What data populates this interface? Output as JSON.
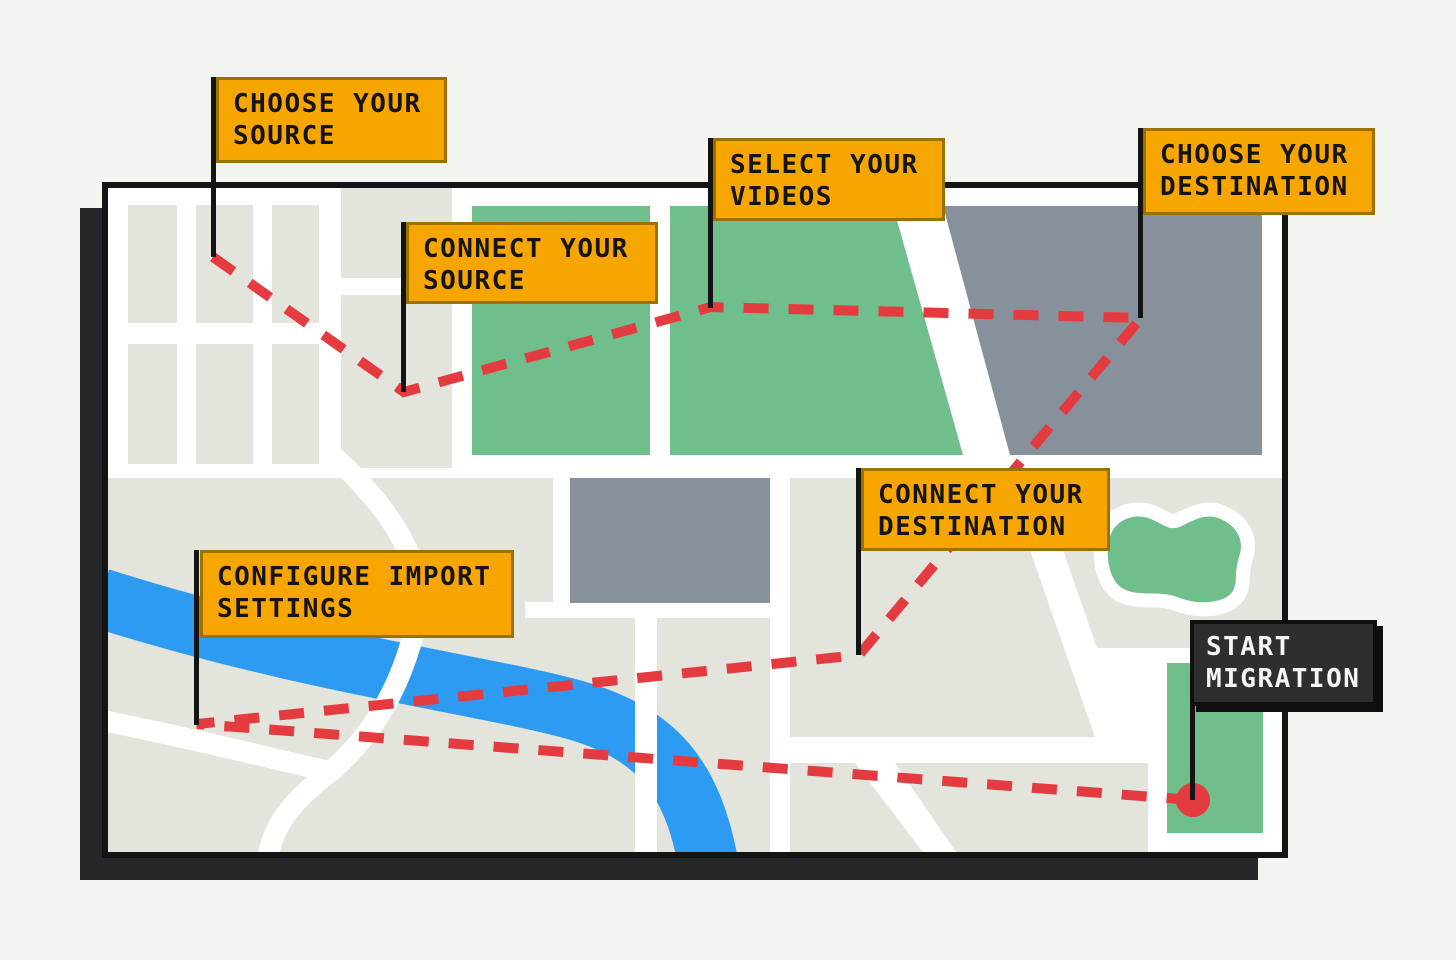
{
  "steps": [
    {
      "id": "choose-source",
      "label": "CHOOSE YOUR SOURCE",
      "line1": "CHOOSE YOUR",
      "line2": "SOURCE",
      "style": "orange"
    },
    {
      "id": "connect-source",
      "label": "CONNECT YOUR SOURCE",
      "line1": "CONNECT YOUR",
      "line2": "SOURCE",
      "style": "orange"
    },
    {
      "id": "select-videos",
      "label": "SELECT YOUR VIDEOS",
      "line1": "SELECT YOUR",
      "line2": "VIDEOS",
      "style": "orange"
    },
    {
      "id": "choose-destination",
      "label": "CHOOSE YOUR DESTINATION",
      "line1": "CHOOSE YOUR",
      "line2": "DESTINATION",
      "style": "orange"
    },
    {
      "id": "connect-destination",
      "label": "CONNECT YOUR DESTINATION",
      "line1": "CONNECT YOUR",
      "line2": "DESTINATION",
      "style": "orange"
    },
    {
      "id": "configure-import-settings",
      "label": "CONFIGURE IMPORT SETTINGS",
      "line1": "CONFIGURE IMPORT",
      "line2": "SETTINGS",
      "style": "orange"
    },
    {
      "id": "start-migration",
      "label": "START MIGRATION",
      "line1": "START",
      "line2": "MIGRATION",
      "style": "dark"
    }
  ],
  "route": {
    "points": [
      [
        213,
        257
      ],
      [
        404,
        392
      ],
      [
        711,
        307
      ],
      [
        1141,
        318
      ],
      [
        859,
        655
      ],
      [
        197,
        724
      ],
      [
        1193,
        800
      ]
    ],
    "endpoint": {
      "x": 1193,
      "y": 800,
      "radius": 17
    }
  },
  "colors": {
    "background": "#F2F4EF",
    "map_shadow": "#25272A",
    "map_outline": "#141414",
    "label_orange": "#F7A600",
    "label_orange_border": "#9B7100",
    "label_dark": "#2E2E2E",
    "label_dark_border": "#0F0F0F",
    "label_dark_text": "#F5F5F2",
    "route_red": "#E33B40",
    "river_blue": "#2E9BF2",
    "park_green": "#6FBE8C",
    "block_slate": "#87919B",
    "block_beige": "#E3E4DC"
  }
}
